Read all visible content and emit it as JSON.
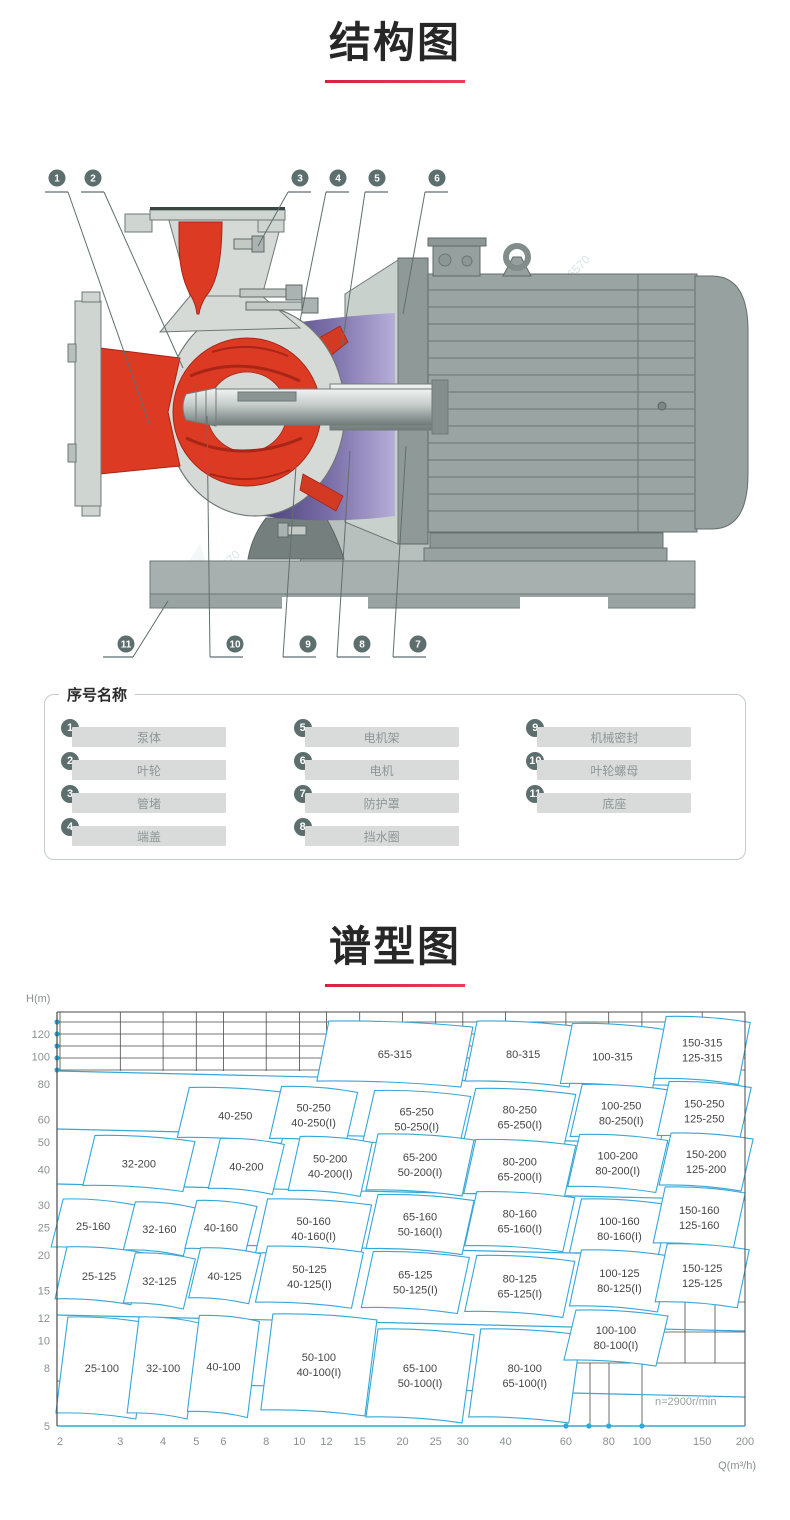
{
  "sections": {
    "structure": {
      "title": "结构图"
    },
    "spectrum": {
      "title": "谱型图"
    }
  },
  "structure": {
    "callouts_top": [
      "1",
      "2",
      "3",
      "4",
      "5",
      "6"
    ],
    "callouts_bottom": [
      "11",
      "10",
      "9",
      "8",
      "7"
    ],
    "watermark": "850-6570"
  },
  "parts_panel": {
    "title": "序号名称",
    "items": [
      {
        "num": "1",
        "label": "泵体"
      },
      {
        "num": "2",
        "label": "叶轮"
      },
      {
        "num": "3",
        "label": "管堵"
      },
      {
        "num": "4",
        "label": "端盖"
      },
      {
        "num": "5",
        "label": "电机架"
      },
      {
        "num": "6",
        "label": "电机"
      },
      {
        "num": "7",
        "label": "防护罩"
      },
      {
        "num": "8",
        "label": "挡水圈"
      },
      {
        "num": "9",
        "label": "机械密封"
      },
      {
        "num": "10",
        "label": "叶轮螺母"
      },
      {
        "num": "11",
        "label": "底座"
      }
    ]
  },
  "colors": {
    "accent_red": "#e62b49",
    "chart_blue": "#35a7d8",
    "pump_red": "#dd3a23",
    "bracket_purple": "#564a85",
    "metal_gray": "#9aa5a3",
    "badge_gray": "#5d6e6e"
  },
  "chart_data": {
    "type": "heatmap",
    "subtype": "pump-selection-region-map",
    "title": "谱型图",
    "xlabel": "Q(m³/h)",
    "ylabel": "H(m)",
    "speed_note": "n=2900r/min",
    "x_scale": "log",
    "y_scale": "log",
    "xlim": [
      2,
      200
    ],
    "ylim": [
      5,
      140
    ],
    "x_ticks": [
      2,
      3,
      4,
      5,
      6,
      8,
      10,
      12,
      15,
      20,
      25,
      30,
      40,
      60,
      80,
      100,
      150,
      200
    ],
    "y_ticks": [
      120,
      100,
      80,
      60,
      50,
      40,
      30,
      25,
      20,
      15,
      12,
      10,
      8,
      5
    ],
    "axis_dot_flows": [
      60,
      70,
      80,
      100
    ],
    "grid": true,
    "legend": "none",
    "regions": [
      {
        "models": [
          "65-315"
        ],
        "q": 19,
        "h": 102,
        "w": 72,
        "hh": 30
      },
      {
        "models": [
          "80-315"
        ],
        "q": 45,
        "h": 102,
        "w": 52,
        "hh": 30
      },
      {
        "models": [
          "100-315"
        ],
        "q": 82,
        "h": 100,
        "w": 46,
        "hh": 30
      },
      {
        "models": [
          "150-315",
          "125-315"
        ],
        "q": 150,
        "h": 105,
        "w": 42,
        "hh": 31
      },
      {
        "models": [
          "40-250"
        ],
        "q": 6.5,
        "h": 62,
        "w": 52,
        "hh": 25
      },
      {
        "models": [
          "50-250",
          "40-250(I)"
        ],
        "q": 11,
        "h": 62,
        "w": 38,
        "hh": 26
      },
      {
        "models": [
          "65-250",
          "50-250(I)"
        ],
        "q": 22,
        "h": 60,
        "w": 48,
        "hh": 26
      },
      {
        "models": [
          "80-250",
          "65-250(I)"
        ],
        "q": 44,
        "h": 61,
        "w": 50,
        "hh": 26
      },
      {
        "models": [
          "100-250",
          "80-250(I)"
        ],
        "q": 87,
        "h": 63,
        "w": 45,
        "hh": 26
      },
      {
        "models": [
          "150-250",
          "125-250"
        ],
        "q": 152,
        "h": 64,
        "w": 41,
        "hh": 27
      },
      {
        "models": [
          "32-200"
        ],
        "q": 3.4,
        "h": 42,
        "w": 50,
        "hh": 25
      },
      {
        "models": [
          "40-200"
        ],
        "q": 7,
        "h": 41,
        "w": 32,
        "hh": 25
      },
      {
        "models": [
          "50-200",
          "40-200(I)"
        ],
        "q": 12.3,
        "h": 41,
        "w": 36,
        "hh": 27
      },
      {
        "models": [
          "65-200",
          "50-200(I)"
        ],
        "q": 22.5,
        "h": 41.5,
        "w": 48,
        "hh": 28
      },
      {
        "models": [
          "80-200",
          "65-200(I)"
        ],
        "q": 44,
        "h": 40,
        "w": 50,
        "hh": 27
      },
      {
        "models": [
          "100-200",
          "80-200(I)"
        ],
        "q": 85,
        "h": 42,
        "w": 44,
        "hh": 26
      },
      {
        "models": [
          "150-200",
          "125-200"
        ],
        "q": 154,
        "h": 42.5,
        "w": 41,
        "hh": 26
      },
      {
        "models": [
          "25-160"
        ],
        "q": 2.5,
        "h": 25.3,
        "w": 36,
        "hh": 24
      },
      {
        "models": [
          "32-160"
        ],
        "q": 3.9,
        "h": 24.7,
        "w": 30,
        "hh": 24
      },
      {
        "models": [
          "40-160"
        ],
        "q": 5.9,
        "h": 25,
        "w": 30,
        "hh": 24
      },
      {
        "models": [
          "50-160",
          "40-160(I)"
        ],
        "q": 11,
        "h": 24.7,
        "w": 52,
        "hh": 27
      },
      {
        "models": [
          "65-160",
          "50-160(I)"
        ],
        "q": 22.5,
        "h": 25.6,
        "w": 48,
        "hh": 27
      },
      {
        "models": [
          "80-160",
          "65-160(I)"
        ],
        "q": 44,
        "h": 26.2,
        "w": 49,
        "hh": 27
      },
      {
        "models": [
          "100-160",
          "80-160(I)"
        ],
        "q": 86,
        "h": 24.7,
        "w": 44,
        "hh": 27
      },
      {
        "models": [
          "150-160",
          "125-160"
        ],
        "q": 147,
        "h": 27,
        "w": 40,
        "hh": 28
      },
      {
        "models": [
          "25-125"
        ],
        "q": 2.6,
        "h": 16.9,
        "w": 38,
        "hh": 26
      },
      {
        "models": [
          "32-125"
        ],
        "q": 3.9,
        "h": 16.2,
        "w": 30,
        "hh": 25
      },
      {
        "models": [
          "40-125"
        ],
        "q": 6.05,
        "h": 16.9,
        "w": 30,
        "hh": 25
      },
      {
        "models": [
          "50-125",
          "40-125(I)"
        ],
        "q": 10.7,
        "h": 16.7,
        "w": 48,
        "hh": 28
      },
      {
        "models": [
          "65-125",
          "50-125(I)"
        ],
        "q": 21.8,
        "h": 16,
        "w": 48,
        "hh": 28
      },
      {
        "models": [
          "80-125",
          "65-125(I)"
        ],
        "q": 44,
        "h": 15.5,
        "w": 49,
        "hh": 28
      },
      {
        "models": [
          "100-125",
          "80-125(I)"
        ],
        "q": 86,
        "h": 16.2,
        "w": 44,
        "hh": 28
      },
      {
        "models": [
          "150-125",
          "125-125"
        ],
        "q": 150,
        "h": 16.9,
        "w": 41,
        "hh": 29
      },
      {
        "models": [
          "25-100"
        ],
        "q": 2.65,
        "h": 8,
        "w": 40,
        "hh": 48
      },
      {
        "models": [
          "32-100"
        ],
        "q": 4,
        "h": 8,
        "w": 30,
        "hh": 48
      },
      {
        "models": [
          "40-100"
        ],
        "q": 6,
        "h": 8.1,
        "w": 30,
        "hh": 48
      },
      {
        "models": [
          "50-100",
          "40-100(I)"
        ],
        "q": 11.4,
        "h": 8.2,
        "w": 52,
        "hh": 48
      },
      {
        "models": [
          "65-100",
          "50-100(I)"
        ],
        "q": 22.5,
        "h": 7.5,
        "w": 48,
        "hh": 44
      },
      {
        "models": [
          "80-100",
          "65-100(I)"
        ],
        "q": 45.5,
        "h": 7.5,
        "w": 50,
        "hh": 44
      },
      {
        "models": [
          "100-100",
          "80-100(I)"
        ],
        "q": 84,
        "h": 10.2,
        "w": 46,
        "hh": 25
      }
    ]
  }
}
